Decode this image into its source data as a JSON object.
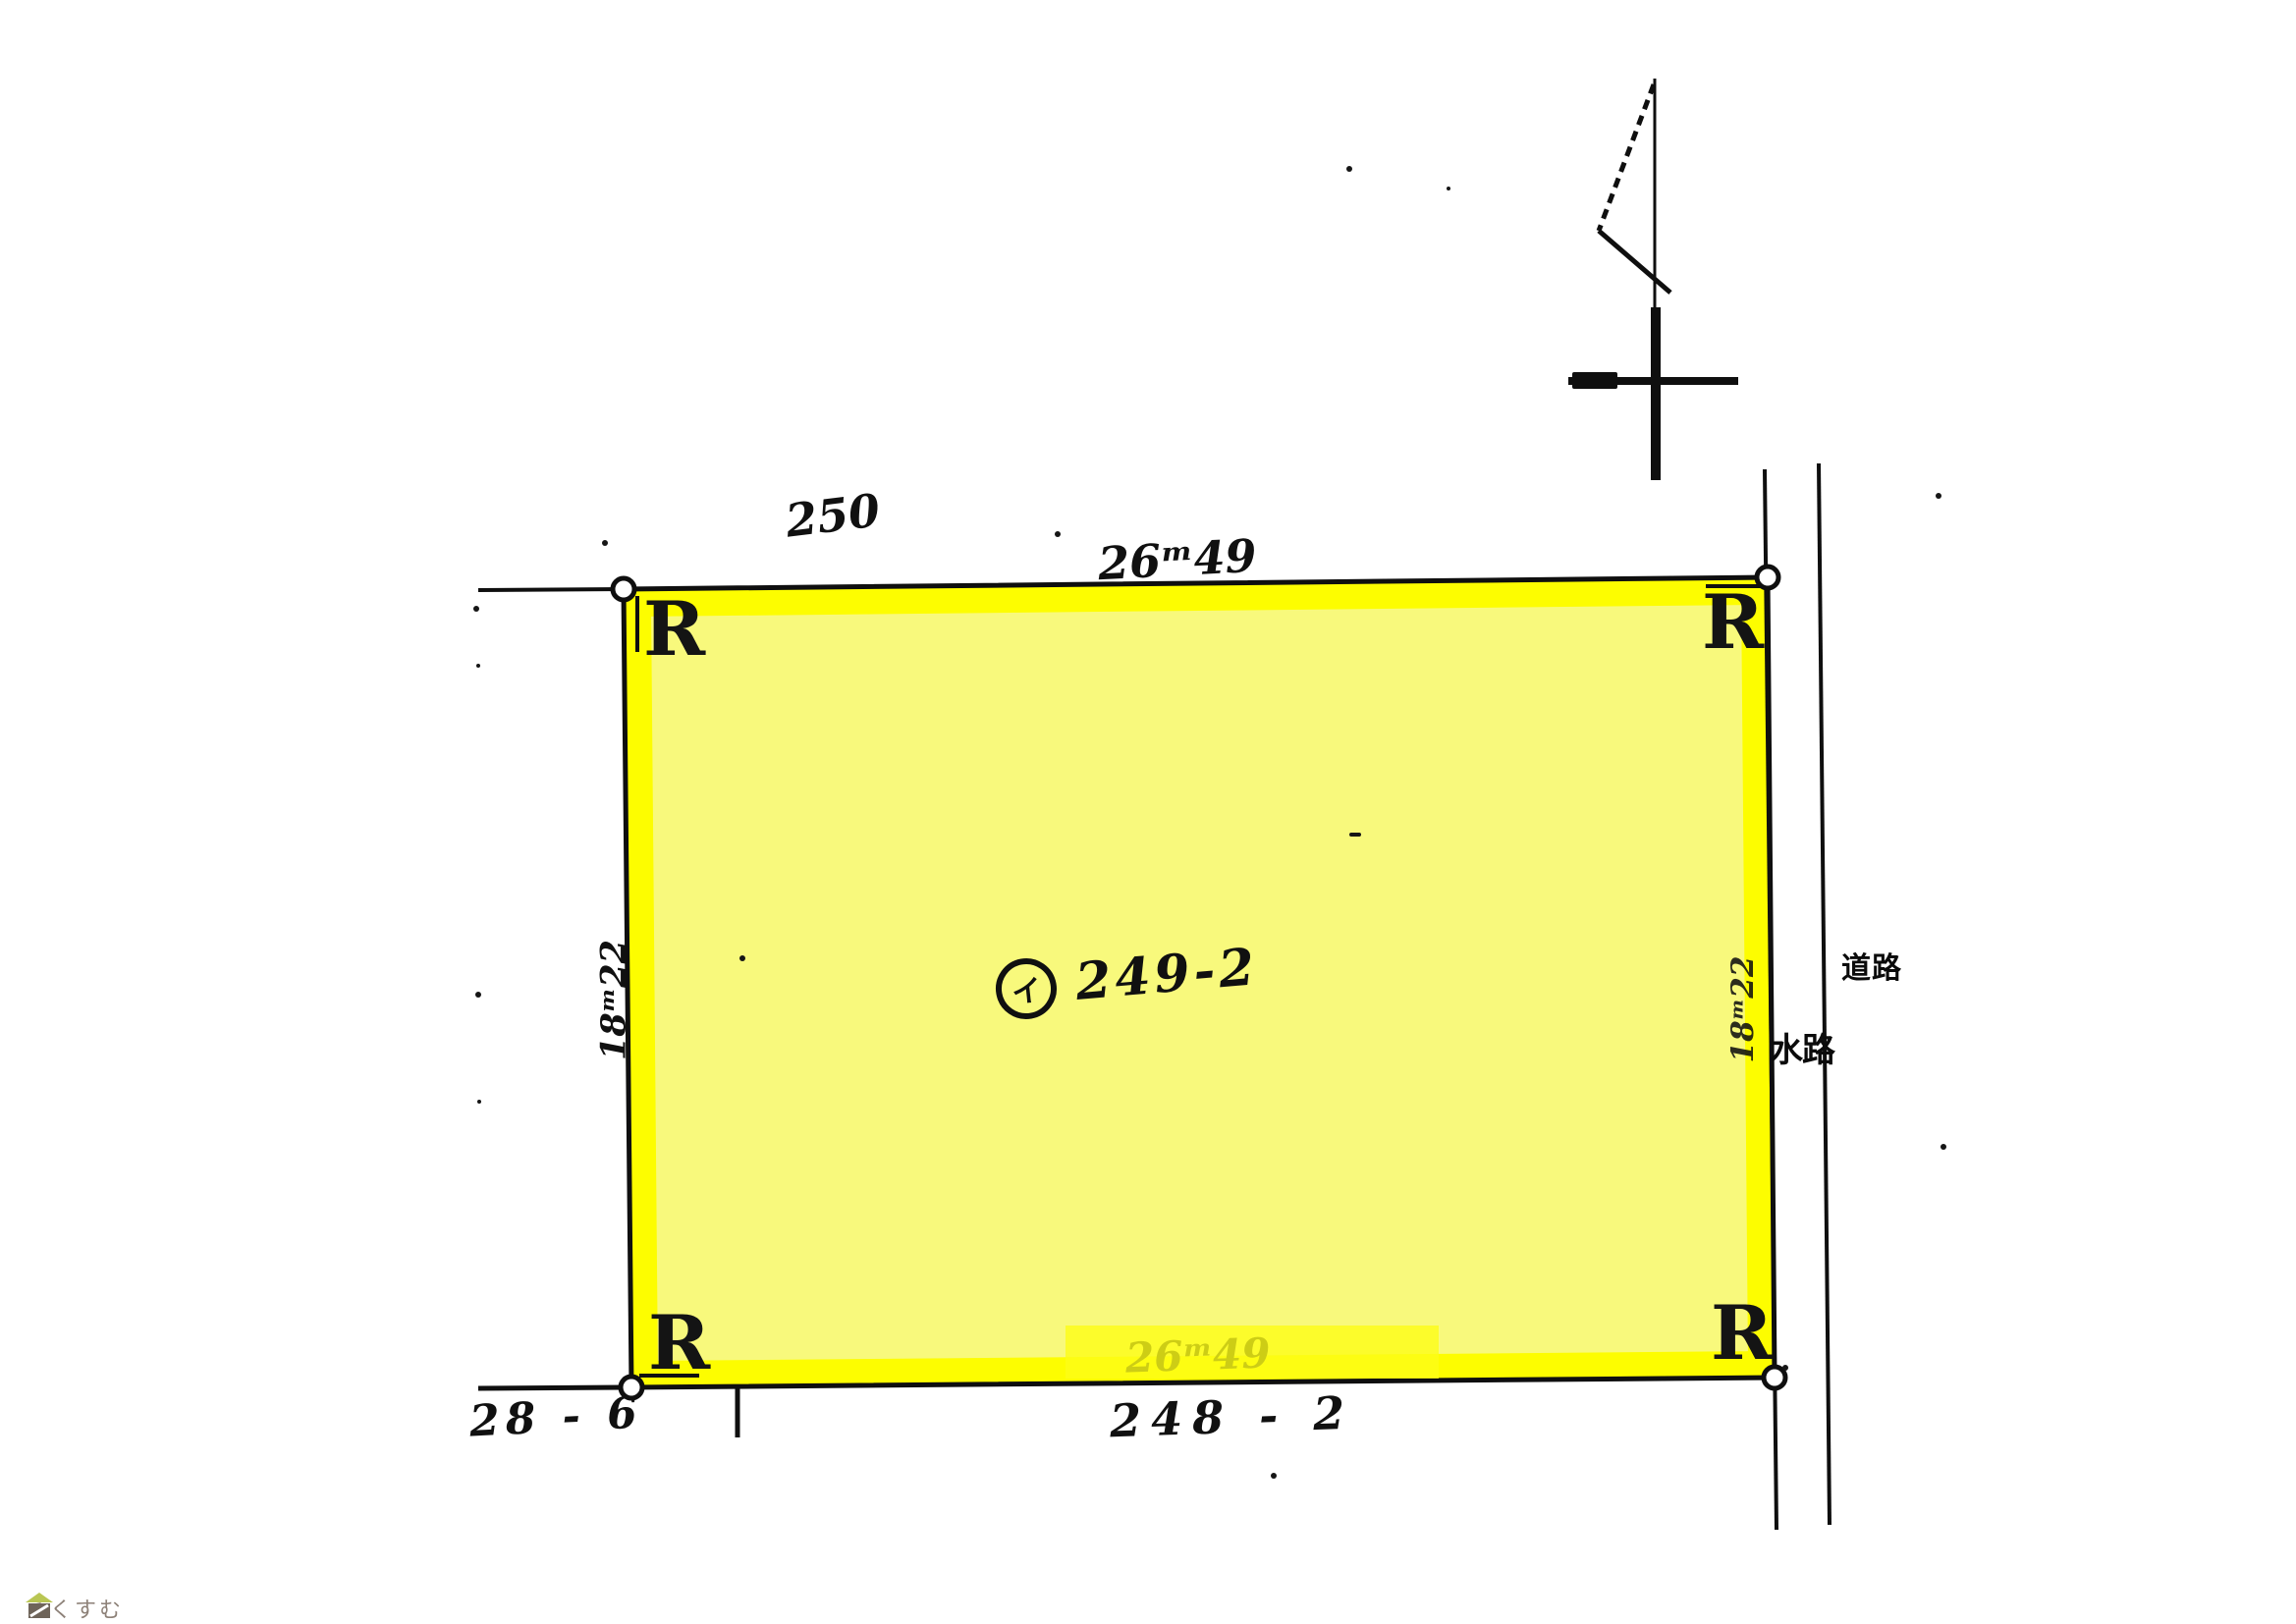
{
  "parcel": {
    "corner_mark": "R",
    "owner_mark": "イ",
    "lot_number": "249-2",
    "top_dimension": "26ᵐ49",
    "bottom_dimension": "26ᵐ49",
    "left_dimension": "18ᵐ22",
    "right_dimension": "18ᵐ22",
    "highlight_border_color": "#fdfd00",
    "highlight_fill_color": "#f8f97c"
  },
  "adjacent_lots": {
    "top": "250",
    "bottom": "248 - 2",
    "bottom_left": "28 - 6"
  },
  "right_features": {
    "waterway": "水路",
    "road": "道路"
  },
  "watermark": {
    "brand": "らくすむ",
    "icon": "house-icon",
    "color": "#8d8178"
  },
  "ink_color": "#101010"
}
